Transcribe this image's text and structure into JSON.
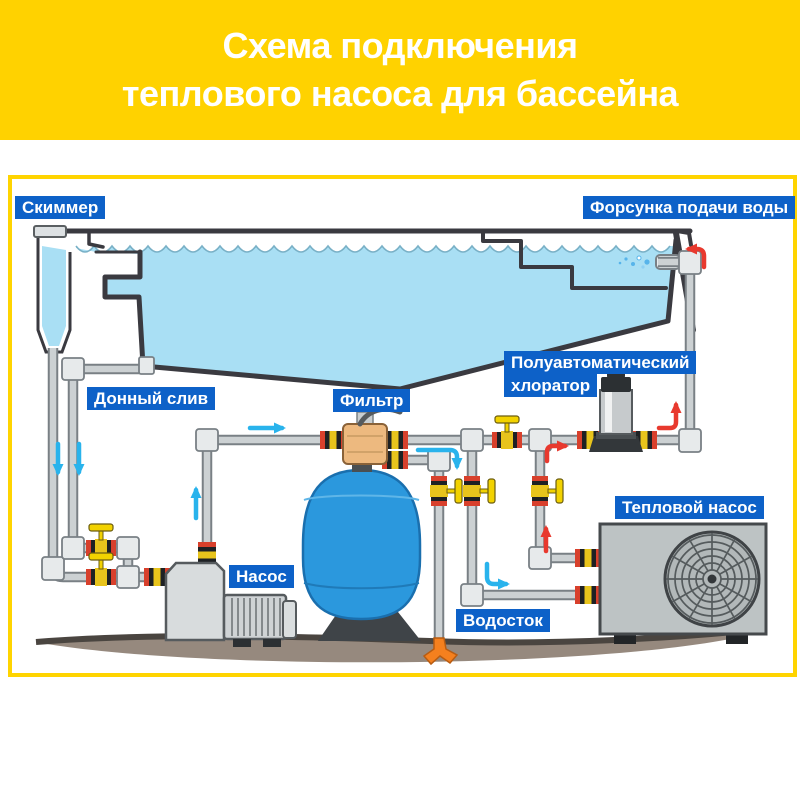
{
  "title": {
    "line1": "Схема подключения",
    "line2": "теплового насоса для бассейна"
  },
  "labels": {
    "skimmer": "Скиммер",
    "water_supply_nozzle": "Форсунка подачи воды",
    "bottom_drain": "Донный слив",
    "filter": "Фильтр",
    "chlorinator_line1": "Полуавтоматический",
    "chlorinator_line2": "хлоратор",
    "pump": "Насос",
    "heat_pump": "Тепловой насос",
    "drain": "Водосток"
  },
  "colors": {
    "banner_yellow": "#ffd200",
    "frame_border_yellow": "#ffd400",
    "label_background_blue": "#0d61c8",
    "label_text_white": "#ffffff",
    "pool_water_blue": "#a9dff4",
    "filter_tank_blue": "#2b98dd",
    "pipe_gray": "#ccd1d3",
    "hot_flow_red": "#e8392e",
    "cold_flow_blue": "#29b3ec",
    "valve_yellow": "#f2d200",
    "ground_brown": "#96897e",
    "drain_orange": "#f5801e"
  }
}
